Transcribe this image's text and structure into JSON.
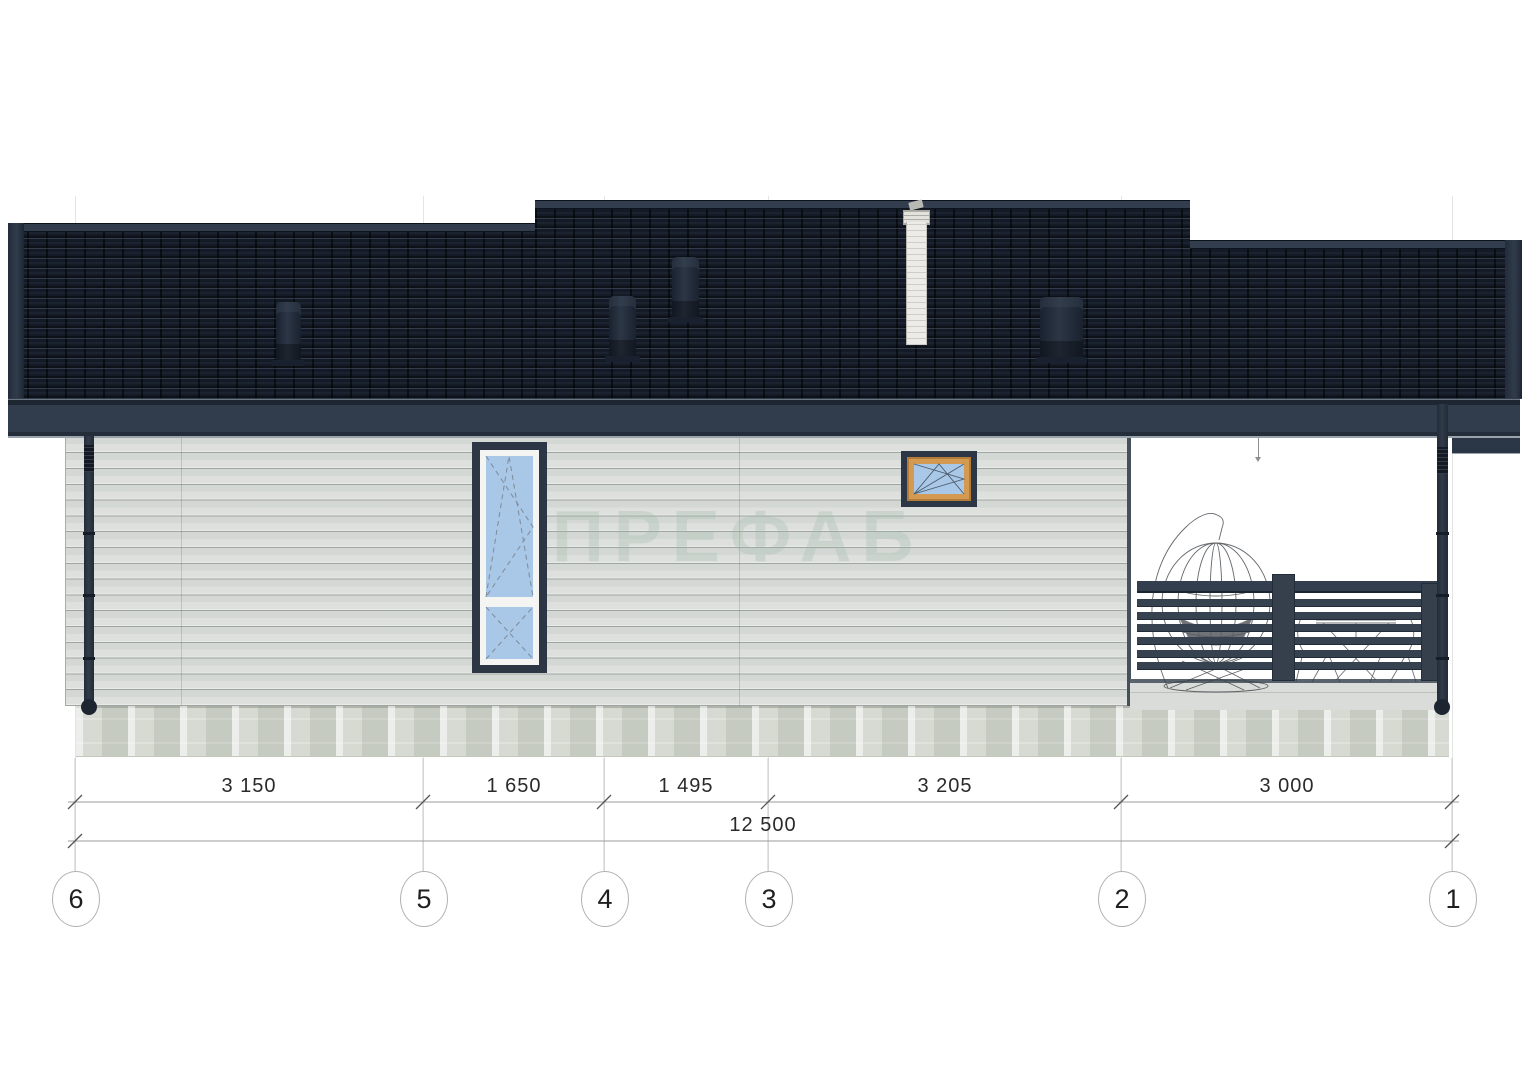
{
  "watermark": {
    "text": "ПРЕФАБ"
  },
  "dims": {
    "segments": [
      {
        "label": "3 150",
        "value_mm": 3150
      },
      {
        "label": "1 650",
        "value_mm": 1650
      },
      {
        "label": "1 495",
        "value_mm": 1495
      },
      {
        "label": "3 205",
        "value_mm": 3205
      },
      {
        "label": "3 000",
        "value_mm": 3000
      }
    ],
    "total": {
      "label": "12 500",
      "value_mm": 12500
    }
  },
  "axes": [
    {
      "label": "6"
    },
    {
      "label": "5"
    },
    {
      "label": "4"
    },
    {
      "label": "3"
    },
    {
      "label": "2"
    },
    {
      "label": "1"
    }
  ],
  "colors": {
    "roof_tile": "#141b26",
    "roof_trim": "#313c4c",
    "wall_siding": "#dde0dd",
    "foundation": "#d6dad2",
    "window_glass": "#a9c7e7",
    "window_frame_dark": "#2c3645",
    "window_frame_wood": "#d49a52",
    "railing": "#36424f",
    "dimension_text": "#2a2a2a"
  }
}
